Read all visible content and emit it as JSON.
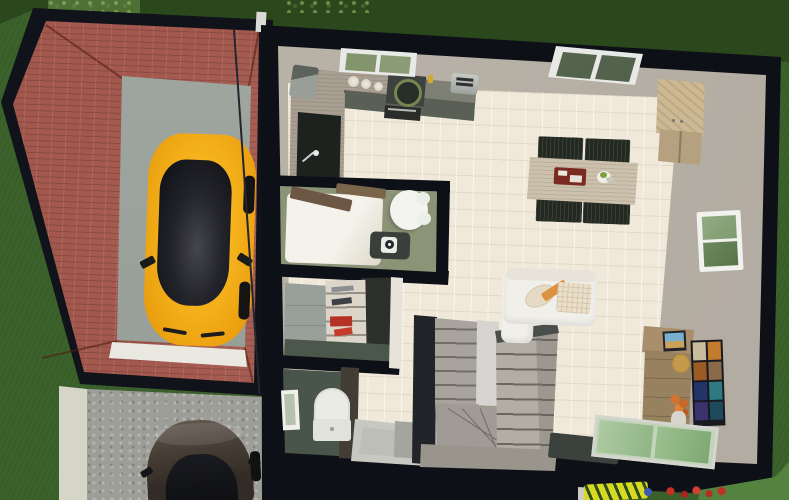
{
  "scene": {
    "view_label": "3D aerial home floor plan render",
    "labels": {
      "canvas": "3D aerial view of house, garage and garden",
      "grass": "Lawn",
      "hedge": "Hedge",
      "driveway": "Paved driveway",
      "concrete_path": "Concrete path",
      "garage": "Garage",
      "garage_roof": "Brick hip roof",
      "garage_floor": "Garage concrete floor",
      "garage_threshold": "Garage door threshold",
      "yellow_car": "Yellow hatchback car",
      "dark_car": "Dark car on driveway",
      "house": "House exterior walls",
      "tile_floor": "Beige tiled floor",
      "wall_band": "Inner wall face",
      "kitchen_window": "Kitchen window",
      "counter": "Kitchen counter",
      "sink": "Kitchen sink with faucet",
      "cooktop": "Cooktop",
      "oven": "Oven",
      "toaster": "Toaster",
      "coffee_maker": "Coffee maker",
      "jars": "Storage jars",
      "trash_bin": "Waste bin",
      "dining_table": "Dining table",
      "dining_chair": "Dining chair",
      "serving_tray": "Serving tray",
      "plate": "Plate with food",
      "skylight": "Roof window",
      "wardrobe": "Wardrobe",
      "side_window": "Window",
      "bathroom": "Bathroom",
      "bathtub": "Bathtub with wooden boards",
      "toilet": "Toilet",
      "washing_machine": "Washing machine",
      "storage_room": "Storage room",
      "storage_cabinet": "Storage cabinet",
      "shelf_unit": "Shelving with supplies",
      "wc": "WC",
      "wc_window": "WC window",
      "shower": "Shower tray",
      "staircase": "Winder staircase",
      "sofa": "White corner sofa",
      "cushion": "Sofa cushion",
      "blanket": "Plaid blanket",
      "media_cabinet": "Tall media cabinet",
      "media_shelf": "Wall shelf with colorful media",
      "picture": "Framed picture",
      "clock": "Gold clock",
      "flowers": "Orange flower bouquet",
      "glass_door": "Sliding glass door",
      "door_mat": "Door mat",
      "lounger": "Striped garden lounger",
      "flower_bed": "Red flower bed",
      "wire": "Overhead wire"
    },
    "palette": {
      "grass": "#3c622c",
      "grass_dark": "#2b481d",
      "grass_light": "#54833f",
      "wall": "#0e1017",
      "brick_roof": "#a3584d",
      "garage_floor": "#9aa19b",
      "tile_floor": "#f0e9da",
      "wall_face": "#b6afa5",
      "car_yellow": "#f0a614",
      "bathroom_floor": "#8c9377",
      "wc_floor": "#49544a",
      "counter_wood": "#a89e91",
      "counter_front": "#5b6057",
      "table_wood": "#ccc1ac",
      "chair": "#232920",
      "sofa": "#f1efe9",
      "stairs": "#a8a39c",
      "driveway": "#9e9e99",
      "accent_orange": "#dc9240",
      "glass_green": "#8fb585",
      "shelf_red": "#b43326"
    },
    "rooms": [
      {
        "name": "Kitchen",
        "items": [
          "counter",
          "sink",
          "cooktop",
          "oven",
          "toaster",
          "coffee maker",
          "jars",
          "window"
        ]
      },
      {
        "name": "Dining area",
        "items": [
          "table",
          "4 chairs",
          "serving tray",
          "plate",
          "roof window"
        ]
      },
      {
        "name": "Living area",
        "items": [
          "corner sofa",
          "cushions",
          "media cabinet",
          "media shelf",
          "sliding glass door",
          "door mat"
        ]
      },
      {
        "name": "Bathroom",
        "items": [
          "bathtub",
          "toilet",
          "washing machine"
        ]
      },
      {
        "name": "Storage room",
        "items": [
          "cabinet",
          "shelving"
        ]
      },
      {
        "name": "WC",
        "items": [
          "toilet",
          "window",
          "shower"
        ]
      },
      {
        "name": "Hall",
        "items": [
          "winder staircase",
          "wardrobe",
          "side window"
        ]
      },
      {
        "name": "Garage",
        "items": [
          "yellow car"
        ]
      }
    ]
  }
}
